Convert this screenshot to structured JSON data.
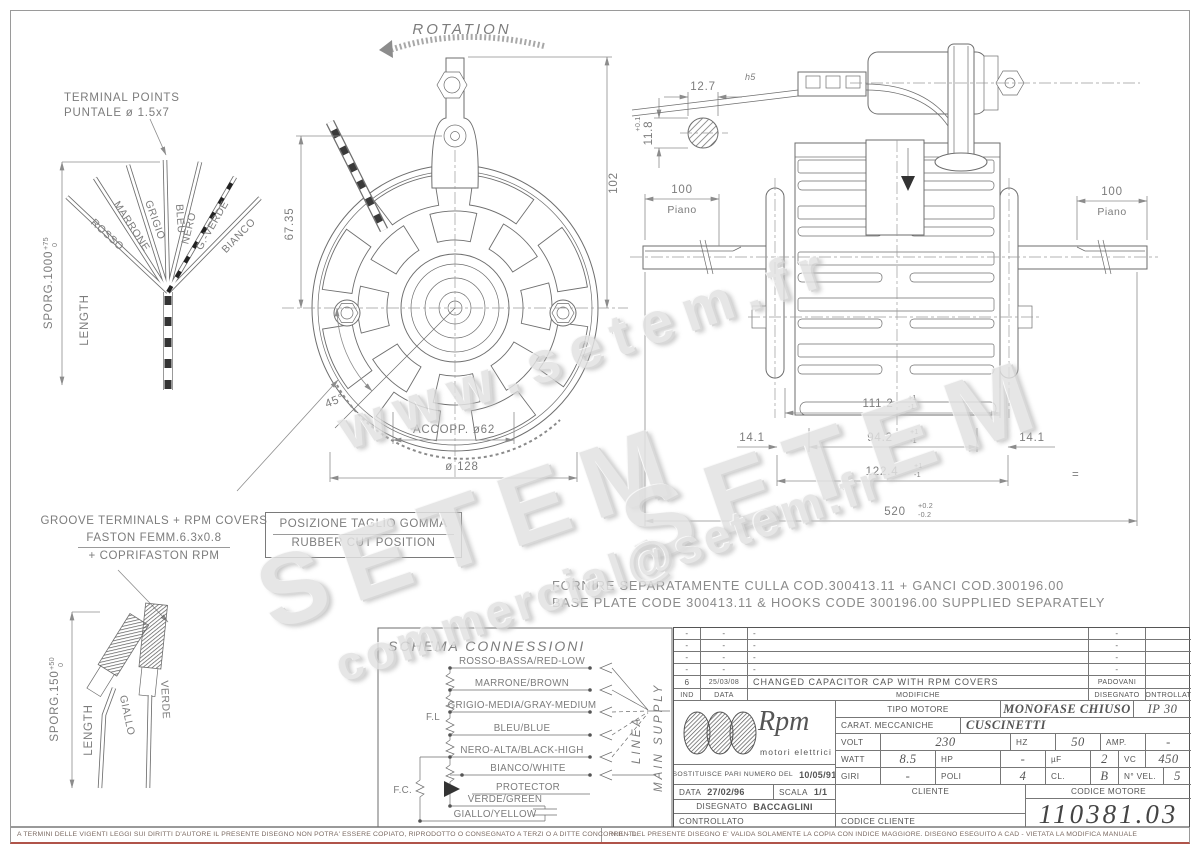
{
  "colors": {
    "line": "#6e6e6e",
    "dim_text": "#7c7c7c",
    "watermark": "#e2e2e2",
    "footer_rule": "#b0544a"
  },
  "watermarks": {
    "url": "www.setem.fr",
    "brand": "SETEM",
    "email": "commercial@setem.fr"
  },
  "terminal_fan": {
    "title1": "TERMINAL POINTS",
    "title2": "PUNTALE ø 1.5x7",
    "sporg": "SPORG.1000",
    "sporg_tp": "+75",
    "sporg_tm": "0",
    "length": "LENGTH",
    "wires": [
      "ROSSO",
      "MARRONE",
      "GRIGIO",
      "BLEU",
      "NERO",
      "G.-VERDE",
      "BIANCO"
    ]
  },
  "front_view": {
    "rotation": "ROTATION",
    "d_height": "102",
    "d_upper": "67.35",
    "angle": "45°",
    "coupling": "ACCOPP. ø62",
    "diameter": "ø 128",
    "rubber_line1": "POSIZIONE TAGLIO GOMMA",
    "rubber_line2": "RUBBER CUT POSITION"
  },
  "side_view": {
    "grommet_w": "12.7",
    "grommet_w_tol": "h5",
    "grommet_h": "11.8",
    "grommet_h_tp": "+0.1",
    "grommet_h_tm": "-0.1",
    "flat_left": "100",
    "flat_left_label": "Piano",
    "flat_right": "100",
    "flat_right_label": "Piano",
    "d1": "111.2",
    "d1p": "+1",
    "d1m": "-1",
    "d2": "94.2",
    "d2p": "+1",
    "d2m": "-1",
    "d3l": "14.1",
    "d3r": "14.1",
    "d4": "122.4",
    "d4p": "+1",
    "d4m": "-1",
    "d5": "520",
    "d5p": "+0.2",
    "d5m": "-0.2",
    "eq": "="
  },
  "groove_note": {
    "line1": "GROOVE TERMINALS + RPM COVERS",
    "line2": "FASTON FEMM.6.3x0.8",
    "line3": "+ COPRIFASTON RPM"
  },
  "lower_terminals": {
    "sporg": "SPORG.150",
    "tp": "+50",
    "tm": "0",
    "length": "LENGTH",
    "wire1": "GIALLO",
    "wire2": "VERDE"
  },
  "supply_note": {
    "line1": "FORNIRE SEPARATAMENTE CULLA COD.300413.11 + GANCI COD.300196.00",
    "line2": "BASE PLATE CODE 300413.11 & HOOKS CODE 300196.00 SUPPLIED SEPARATELY"
  },
  "schema": {
    "title": "SCHEMA CONNESSIONI",
    "wires": [
      "ROSSO-BASSA/RED-LOW",
      "MARRONE/BROWN",
      "GRIGIO-MEDIA/GRAY-MEDIUM",
      "BLEU/BLUE",
      "NERO-ALTA/BLACK-HIGH",
      "BIANCO/WHITE",
      "PROTECTOR",
      "VERDE/GREEN",
      "GIALLO/YELLOW"
    ],
    "fl": "F.L",
    "fc": "F.C.",
    "linea": "LINEA",
    "main_supply": "MAIN SUPPLY"
  },
  "title_block": {
    "revisions": {
      "headers": {
        "ind": "IND",
        "data": "DATA",
        "modifiche": "MODIFICHE",
        "disegnato": "DISEGNATO",
        "controllato": "CONTROLLATO"
      },
      "rows": [
        {
          "ind": "-",
          "data": "-",
          "modifiche": "-",
          "disegnato": "-",
          "controllato": ""
        },
        {
          "ind": "-",
          "data": "-",
          "modifiche": "-",
          "disegnato": "-",
          "controllato": ""
        },
        {
          "ind": "-",
          "data": "-",
          "modifiche": "-",
          "disegnato": "-",
          "controllato": ""
        },
        {
          "ind": "-",
          "data": "-",
          "modifiche": "-",
          "disegnato": "-",
          "controllato": ""
        },
        {
          "ind": "6",
          "data": "25/03/08",
          "modifiche": "CHANGED CAPACITOR CAP WITH RPM COVERS",
          "disegnato": "PADOVANI",
          "controllato": ""
        }
      ]
    },
    "logo": {
      "name": "Rpm",
      "subtitle": "motori elettrici"
    },
    "specs": {
      "tipo_label": "TIPO MOTORE",
      "tipo": "MONOFASE CHIUSO",
      "ip": "IP 30",
      "carat_label": "CARAT. MECCANICHE",
      "carat": "CUSCINETTI",
      "volt_label": "VOLT",
      "volt": "230",
      "hz_label": "HZ",
      "hz": "50",
      "amp_label": "AMP.",
      "amp": "-",
      "watt_label": "WATT",
      "watt": "8.5",
      "hp_label": "HP",
      "hp": "-",
      "uf_label": "µF",
      "uf": "2",
      "vc_label": "VC",
      "vc": "450",
      "giri_label": "GIRI",
      "giri": "-",
      "poli_label": "POLI",
      "poli": "4",
      "cl_label": "CL.",
      "cl": "B",
      "nvel_label": "N° VEL.",
      "nvel": "5"
    },
    "sostituisce_label": "SOSTITUISCE PARI NUMERO DEL",
    "sostituisce_date": "10/05/91",
    "data_label": "DATA",
    "data": "27/02/96",
    "scala_label": "SCALA",
    "scala": "1/1",
    "disegnato_label": "DISEGNATO",
    "disegnato": "BACCAGLINI",
    "controllato_label": "CONTROLLATO",
    "cliente_label": "CLIENTE",
    "codice_cliente_label": "CODICE CLIENTE",
    "codice_motore_label": "CODICE MOTORE",
    "codice_motore": "110381.03"
  },
  "footer": {
    "left": "A TERMINI DELLE VIGENTI LEGGI SUI DIRITTI D'AUTORE IL PRESENTE DISEGNO NON POTRA' ESSERE COPIATO, RIPRODOTTO O CONSEGNATO A TERZI O A DITTE CONCORRENTI.",
    "right": "N.B. - DEL PRESENTE DISEGNO E' VALIDA SOLAMENTE LA COPIA CON INDICE MAGGIORE.    DISEGNO ESEGUITO A CAD - VIETATA LA MODIFICA MANUALE"
  }
}
